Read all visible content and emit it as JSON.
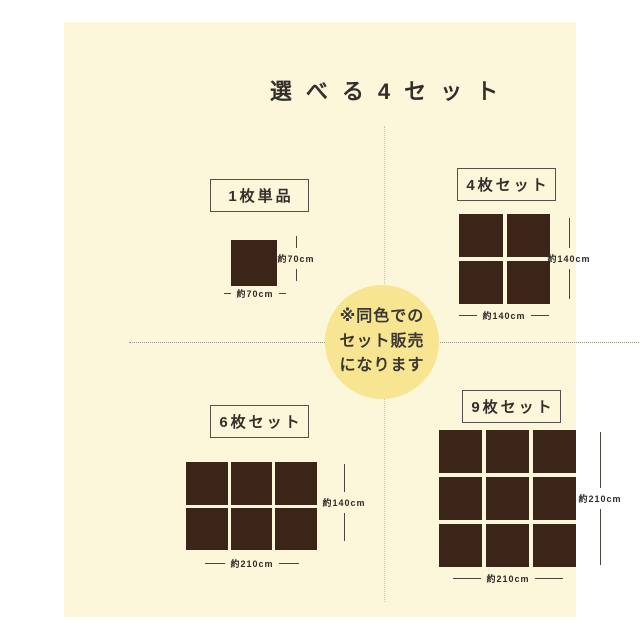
{
  "page": {
    "title": "選べる4セット"
  },
  "colors": {
    "panel_bg": "#FCF6DA",
    "circle_bg": "#F8E592",
    "tile": "#3B2518",
    "text": "#332F2A"
  },
  "center_note": {
    "lines": [
      "※同色での",
      "セット販売",
      "になります"
    ]
  },
  "sets": [
    {
      "id": "single",
      "label": "1枚単品",
      "cols": 1,
      "rows": 1,
      "width_label": "約70cm",
      "height_label": "約70cm"
    },
    {
      "id": "set4",
      "label": "4枚セット",
      "cols": 2,
      "rows": 2,
      "width_label": "約140cm",
      "height_label": "約140cm"
    },
    {
      "id": "set6",
      "label": "6枚セット",
      "cols": 3,
      "rows": 2,
      "width_label": "約210cm",
      "height_label": "約140cm"
    },
    {
      "id": "set9",
      "label": "9枚セット",
      "cols": 3,
      "rows": 3,
      "width_label": "約210cm",
      "height_label": "約210cm"
    }
  ]
}
